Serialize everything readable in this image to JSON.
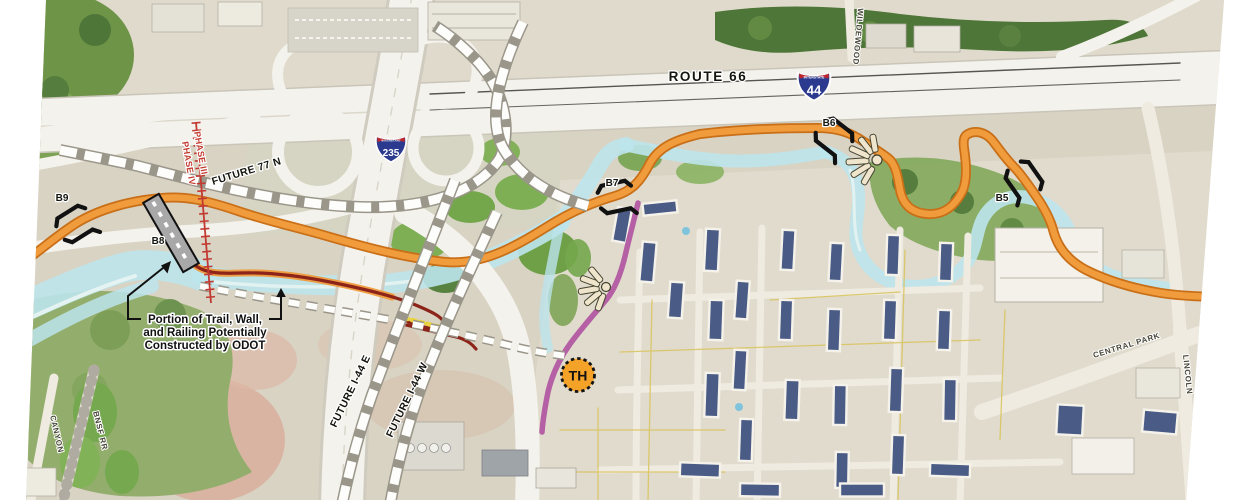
{
  "map": {
    "highways": {
      "route_66": "ROUTE 66",
      "i44_number": "44",
      "i44_banner": "INTERSTATE",
      "i235_number": "235",
      "i235_banner": "INTERSTATE"
    },
    "future_roads": {
      "route_77n": "FUTURE 77 N",
      "i44_east": "FUTURE I-44 E",
      "i44_west": "FUTURE I-44 W"
    },
    "phases": {
      "phase_3": "PHASE III",
      "phase_4": "PHASE IV"
    },
    "bridges": {
      "b5": "B5",
      "b6": "B6",
      "b7": "B7",
      "b8": "B8",
      "b9": "B9"
    },
    "trailhead_label": "TH",
    "annotation": {
      "line1": "Portion of Trail, Wall,",
      "line2": "and Railing Potentially",
      "line3": "Constructed by ODOT"
    },
    "streets": {
      "wildewood": "WILDEWOOD",
      "central_park": "CENTRAL PARK",
      "lincoln": "LINCOLN",
      "bnsf_rr": "BNSF RR",
      "canyon": "CANYON"
    },
    "colors": {
      "trail_orange": "#F09B3C",
      "trail_orange_edge": "#C86F18",
      "odot_trail_maroon": "#8C241A",
      "future_trail_magenta": "#B55FA4",
      "phase_line_red": "#C23B33",
      "construction_yellow": "#E8D23F",
      "water": "#BCE4EC",
      "shield_blue": "#2B3A8F",
      "shield_red": "#C0272D",
      "trailhead_fill": "#F5A328"
    }
  }
}
